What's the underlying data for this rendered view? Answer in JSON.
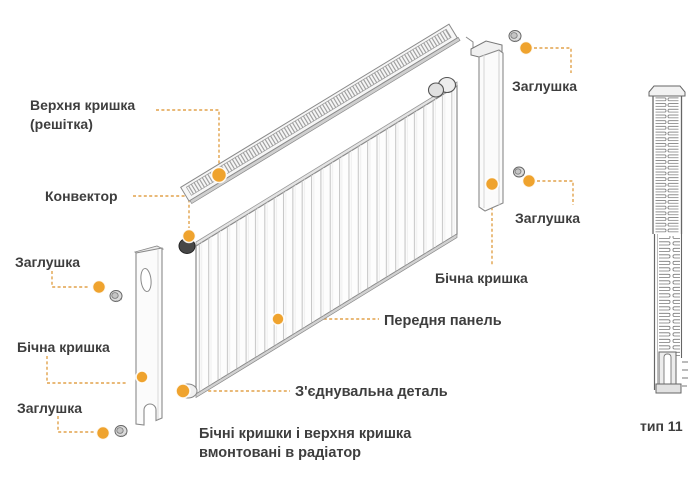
{
  "diagram": {
    "labels": {
      "top_cover_line1": "Верхня кришка",
      "top_cover_line2": "(решітка)",
      "convector": "Конвектор",
      "plug_left_top": "Заглушка",
      "side_cover_left": "Бічна кришка",
      "plug_left_bottom": "Заглушка",
      "plug_right_top": "Заглушка",
      "plug_right_bottom": "Заглушка",
      "side_cover_right": "Бічна кришка",
      "front_panel": "Передня панель",
      "connector": "З'єднувальна деталь"
    },
    "note_line1": "Бічні кришки і верхня кришка",
    "note_line2": "вмонтовані в радіатор",
    "type_label": "тип 11",
    "colors": {
      "accent_dot": "#EFA32E",
      "leader_line": "#E2A24B",
      "text_ink": "#3E3E3E",
      "line_art": "#8A8A8A"
    }
  }
}
